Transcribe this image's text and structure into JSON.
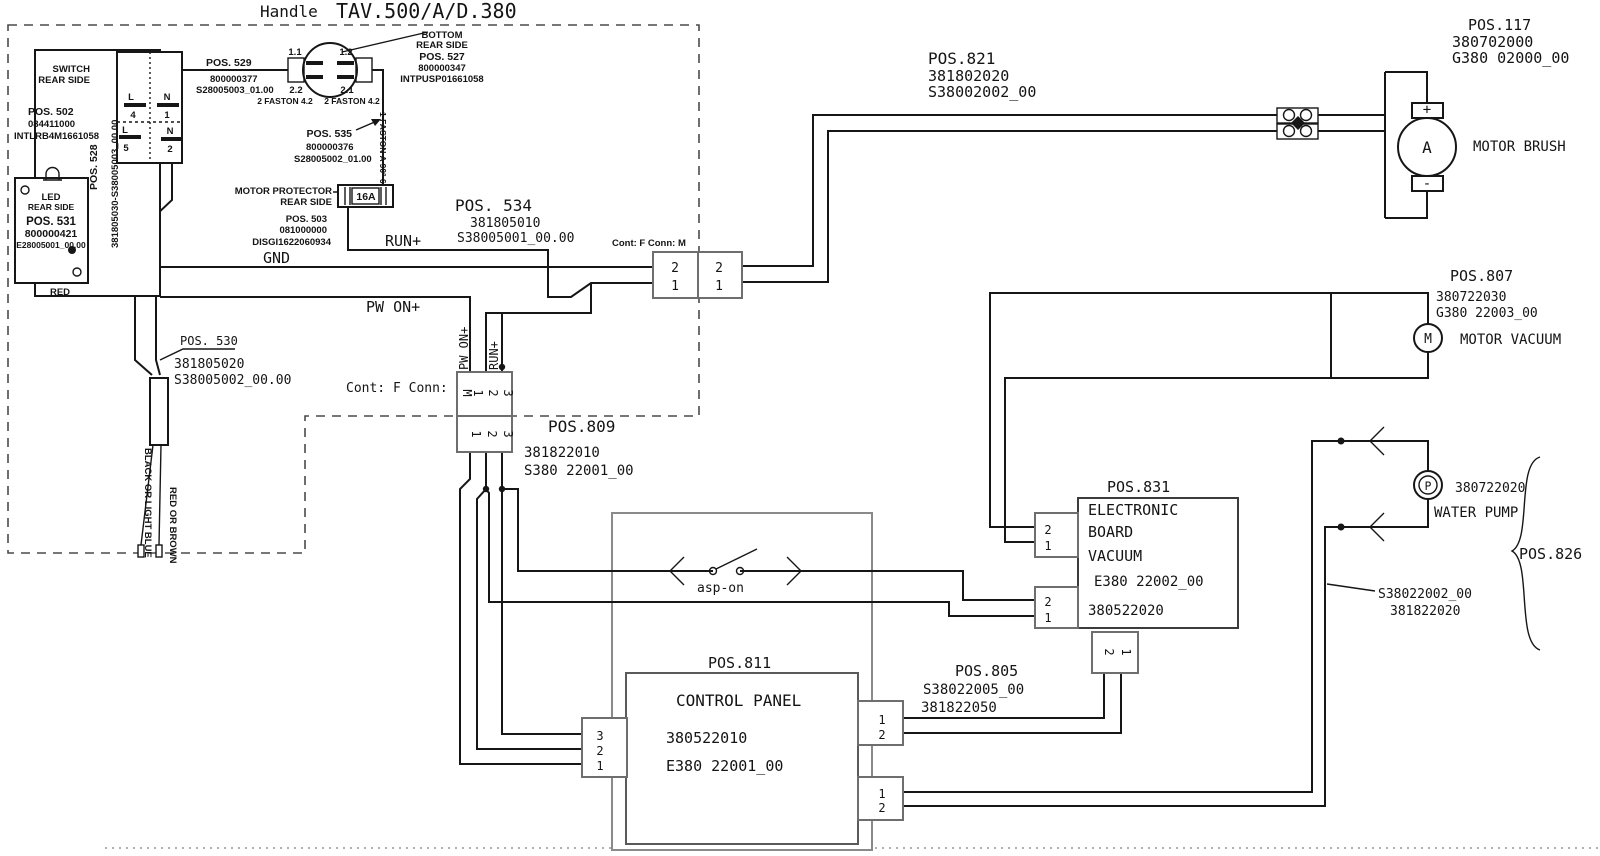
{
  "title": {
    "handle": "Handle",
    "model": "TAV.500/A/D.380"
  },
  "handle_area": {
    "switch": {
      "l1": "SWITCH",
      "l2": "REAR SIDE",
      "pos": "POS. 502",
      "code1": "084411000",
      "code2": "INTLRB4M1661058",
      "cable_pos": "POS. 528",
      "cable_code": "381805030-S38005003_00.00",
      "contacts": {
        "tl_letter": "L",
        "tl_num": "4",
        "tr_letter": "N",
        "tr_num": "1",
        "bl_letter": "L",
        "bl_num": "5",
        "br_letter": "N",
        "br_num": "2"
      }
    },
    "pos529": {
      "pos": "POS. 529",
      "code1": "800000377",
      "code2": "S28005003_01.00"
    },
    "pos527": {
      "pin11": "1.1",
      "pin12": "1.2",
      "pin22": "2.2",
      "pin21": "2.1",
      "faston_l": "2 FASTON 4.2",
      "faston_r": "2 FASTON 4.2",
      "l1": "BOTTOM",
      "l2": "REAR SIDE",
      "pos": "POS. 527",
      "code1": "800000347",
      "code2": "INTPUSP01661058"
    },
    "pos535": {
      "pos": "POS. 535",
      "code1": "800000376",
      "code2": "S28005002_01.00",
      "faston": "1 FASTON A 90° 6.3"
    },
    "protector": {
      "l1": "MOTOR PROTECTOR",
      "l2": "REAR SIDE",
      "rating": "16A",
      "pos": "POS. 503",
      "code1": "081000000",
      "code2": "DISGI1622060934"
    },
    "led": {
      "l1": "LED",
      "l2": "REAR SIDE",
      "pos": "POS. 531",
      "code1": "800000421",
      "code2": "E28005001_00.00",
      "red": "RED"
    },
    "pos530": {
      "pos": "POS. 530",
      "code1": "381805020",
      "code2": "S38005002_00.00"
    },
    "wire_black": "BLACK OR LIGHT BLUE",
    "wire_red": "RED OR BROWN"
  },
  "signals": {
    "gnd": "GND",
    "run": "RUN+",
    "pwon": "PW ON+",
    "pwon_v": "PW ON+",
    "run_v": "RUN+"
  },
  "conn_h": {
    "label": "Cont: F Conn: M",
    "left": [
      "2",
      "1"
    ],
    "right": [
      "2",
      "1"
    ]
  },
  "conn_v": {
    "label": "Cont: F Conn:",
    "m": "M",
    "top": [
      "1",
      "2",
      "3"
    ],
    "bottom": [
      "1",
      "2",
      "3"
    ]
  },
  "pos809": {
    "pos": "POS.809",
    "code1": "381822010",
    "code2": "S380 22001_00"
  },
  "pos821": {
    "pos": "POS.821",
    "code1": "381802020",
    "code2": "S38002002_00"
  },
  "pos534": {
    "pos": "POS. 534",
    "code1": "381805010",
    "code2": "S38005001_00.00"
  },
  "motor_brush": {
    "pos": "POS.117",
    "code1": "380702000",
    "code2": "G380 02000_00",
    "name": "MOTOR BRUSH",
    "sym": "A",
    "plus": "+",
    "minus": "-"
  },
  "motor_vacuum": {
    "pos": "POS.807",
    "code1": "380722030",
    "code2": "G380 22003_00",
    "name": "MOTOR VACUUM",
    "sym": "M"
  },
  "water_pump": {
    "sym": "P",
    "code": "380722020",
    "name": "WATER PUMP",
    "pos": "POS.826",
    "cable1": "S38022002_00",
    "cable2": "381822020"
  },
  "board": {
    "pos": "POS.831",
    "l1": "ELECTRONIC",
    "l2": "BOARD",
    "l3": "VACUUM",
    "code1": "E380 22002_00",
    "code2": "380522020",
    "conn_top": [
      "2",
      "1"
    ],
    "conn_bot": [
      "2",
      "1"
    ],
    "conn_out": [
      "2",
      "1"
    ]
  },
  "pos805": {
    "pos": "POS.805",
    "code1": "S38022005_00",
    "code2": "381822050"
  },
  "panel": {
    "pos": "POS.811",
    "name": "CONTROL PANEL",
    "code1": "380522010",
    "code2": "E380 22001_00",
    "conn_left": [
      "3",
      "2",
      "1"
    ],
    "conn_r1": [
      "1",
      "2"
    ],
    "conn_r2": [
      "1",
      "2"
    ],
    "asp": "asp-on"
  }
}
